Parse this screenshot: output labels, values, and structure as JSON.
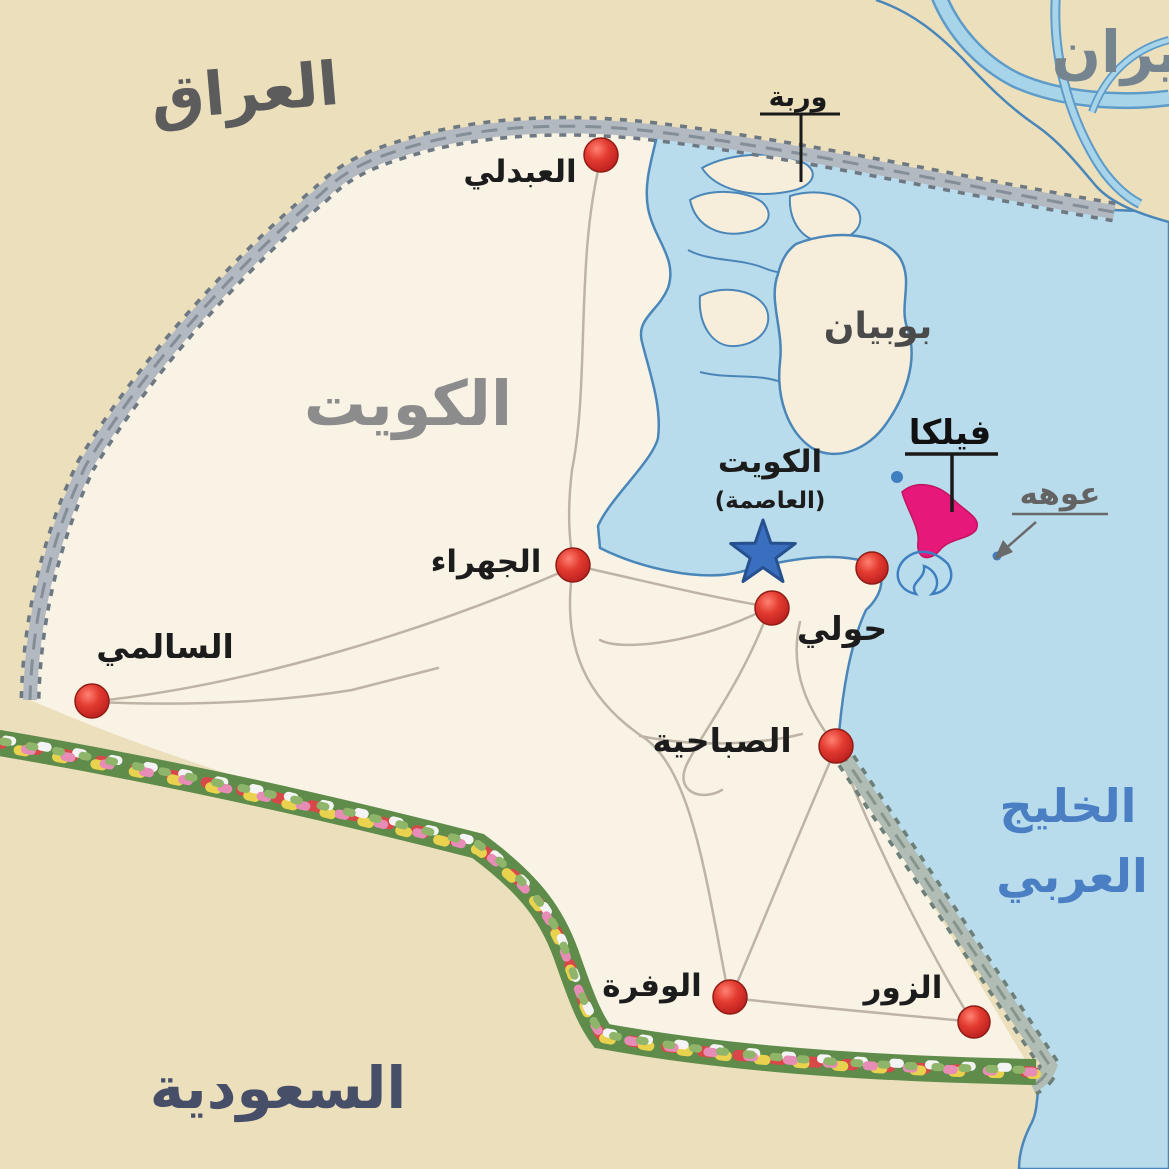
{
  "map": {
    "regions": {
      "iraq": {
        "label": "العراق"
      },
      "iran": {
        "label": "ايران"
      },
      "kuwait": {
        "label": "الكويت"
      },
      "saudi_arabia": {
        "label": "السعودية"
      }
    },
    "water_labels": {
      "gulf_line1": "الخليج",
      "gulf_line2": "العربي"
    },
    "islands": {
      "bubiyan": {
        "label": "بوبيان"
      },
      "warbah": {
        "label": "وربة"
      },
      "failaka": {
        "label": "فيلكا"
      },
      "auhah": {
        "label": "عوهه"
      }
    },
    "capital": {
      "name": "الكويت",
      "designation": "(العاصمة)"
    },
    "cities": {
      "abdali": {
        "label": "العبدلي"
      },
      "jahra": {
        "label": "الجهراء"
      },
      "salmi": {
        "label": "السالمي"
      },
      "hawalli": {
        "label": "حولي"
      },
      "sabahiya": {
        "label": "الصباحية"
      },
      "wafra": {
        "label": "الوفرة"
      },
      "zour": {
        "label": "الزور"
      }
    },
    "colors": {
      "sea": "#b9dcec",
      "outer_land": "#ecdfbc",
      "kuwait_land": "#f9f3e6",
      "city_marker": "#d63230",
      "capital_star": "#3a6fc0",
      "failaka_island": "#e6197b",
      "gulf_text": "#4a7fc3"
    }
  }
}
